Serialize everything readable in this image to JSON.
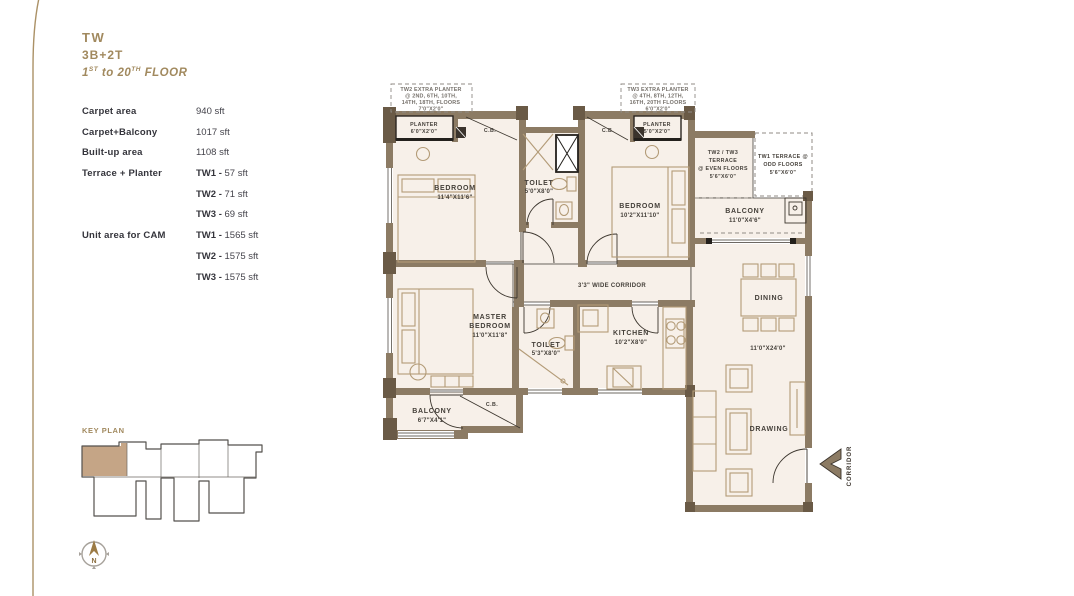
{
  "header": {
    "tower": "TW",
    "config": "3B+2T",
    "floor": {
      "f1": "1",
      "f1s": "ST",
      "f2": " to 20",
      "f2s": "TH",
      "f3": " FLOOR"
    }
  },
  "specs": {
    "rows": [
      {
        "label": "Carpet area",
        "bold": "",
        "value": "940 sft"
      },
      {
        "label": "Carpet+Balcony",
        "bold": "",
        "value": "1017 sft"
      },
      {
        "label": "Built-up area",
        "bold": "",
        "value": "1108 sft"
      },
      {
        "label": "Terrace + Planter",
        "bold": "TW1 - ",
        "value": "57 sft"
      },
      {
        "label": "",
        "bold": "TW2 - ",
        "value": "71 sft"
      },
      {
        "label": "",
        "bold": "TW3 - ",
        "value": "69 sft"
      },
      {
        "label": "Unit area for CAM",
        "bold": "TW1 - ",
        "value": "1565 sft"
      },
      {
        "label": "",
        "bold": "TW2 - ",
        "value": "1575 sft"
      },
      {
        "label": "",
        "bold": "TW3 - ",
        "value": "1575 sft"
      }
    ]
  },
  "key_plan": {
    "title": "KEY PLAN"
  },
  "compass": {
    "north": "N"
  },
  "colors": {
    "accent_gold": "#a1895e",
    "wall_brown": "#8c7b64",
    "floor_cream": "#f7f0e9",
    "highlight_tan": "#c5a586"
  },
  "plan": {
    "annotations": {
      "left": [
        "TW2 EXTRA PLANTER",
        "@ 2ND, 6TH, 10TH,",
        "14TH, 18TH, FLOORS",
        "7'0\"X2'0\""
      ],
      "right": [
        "TW3 EXTRA PLANTER",
        "@ 4TH, 8TH, 12TH,",
        "16TH, 20TH FLOORS",
        "6'0\"X2'0\""
      ]
    },
    "rooms": {
      "planter1": [
        "PLANTER",
        "6'0\"X2'0\""
      ],
      "planter2": [
        "PLANTER",
        "5'0\"X2'0\""
      ],
      "bedroom1": [
        "BEDROOM",
        "11'4\"X11'6\""
      ],
      "bedroom2": [
        "BEDROOM",
        "10'2\"X11'10\""
      ],
      "toilet1": [
        "TOILET",
        "5'0\"X8'0\""
      ],
      "toilet2": [
        "TOILET",
        "5'3\"X8'0\""
      ],
      "master": [
        "MASTER",
        "BEDROOM",
        "11'0\"X11'8\""
      ],
      "kitchen": [
        "KITCHEN",
        "10'2\"X8'0\""
      ],
      "terrace23": [
        "TW2 / TW3",
        "TERRACE",
        "@ EVEN FLOORS",
        "5'6\"X6'0\""
      ],
      "terrace1": [
        "TW1 TERRACE @",
        "ODD FLOORS",
        "5'6\"X6'0\""
      ],
      "balcony_r": [
        "BALCONY",
        "11'0\"X4'6\""
      ],
      "balcony_bl": [
        "BALCONY",
        "6'7\"X4'1\""
      ],
      "corridor": "3'3\" WIDE CORRIDOR",
      "dining": "DINING",
      "living_dim": "11'0\"X24'0\"",
      "drawing": "DRAWING",
      "cb": "C.B.",
      "corridor_out": "CORRIDOR"
    }
  }
}
